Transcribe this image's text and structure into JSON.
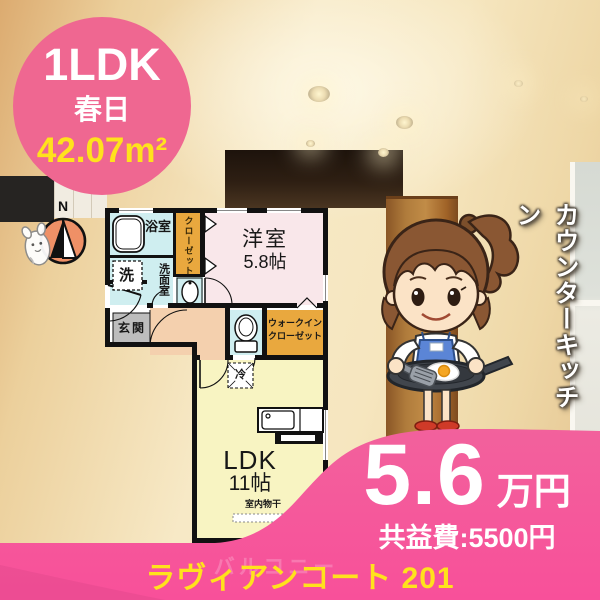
{
  "badge": {
    "type_label": "1LDK",
    "location": "春日",
    "area": "42.07m²"
  },
  "floor_plan": {
    "compass_n": "N",
    "labels": {
      "bath": "浴室",
      "closet": "クローゼット",
      "washer": "洗",
      "washroom": "洗面室",
      "entrance": "玄関",
      "western_room": "洋室",
      "western_room_size": "5.8帖",
      "wic1": "ウォークイン",
      "wic2": "クローゼット",
      "fridge": "冷",
      "ldk": "LDK",
      "ldk_size": "11帖",
      "indoor_drying": "室内物干",
      "ac": "AC",
      "balcony": "バルコニー"
    }
  },
  "right_banner": {
    "text": "カウンターキッチン"
  },
  "price_panel": {
    "rent": "5.6",
    "rent_unit": "万円",
    "common_fee": "共益費:5500円"
  },
  "footer": {
    "property_name": "ラヴィアンコート 201"
  },
  "colors": {
    "accent_pink": "#f4559a",
    "badge_pink": "#ef6791",
    "highlight_yellow": "#ffe21c",
    "room_cyan": "#cfeef0",
    "room_orange": "#e9a83e",
    "room_pink": "#f9e7ea",
    "room_yellow": "#f8f4c2",
    "hall_peach": "#f4d0ae"
  }
}
